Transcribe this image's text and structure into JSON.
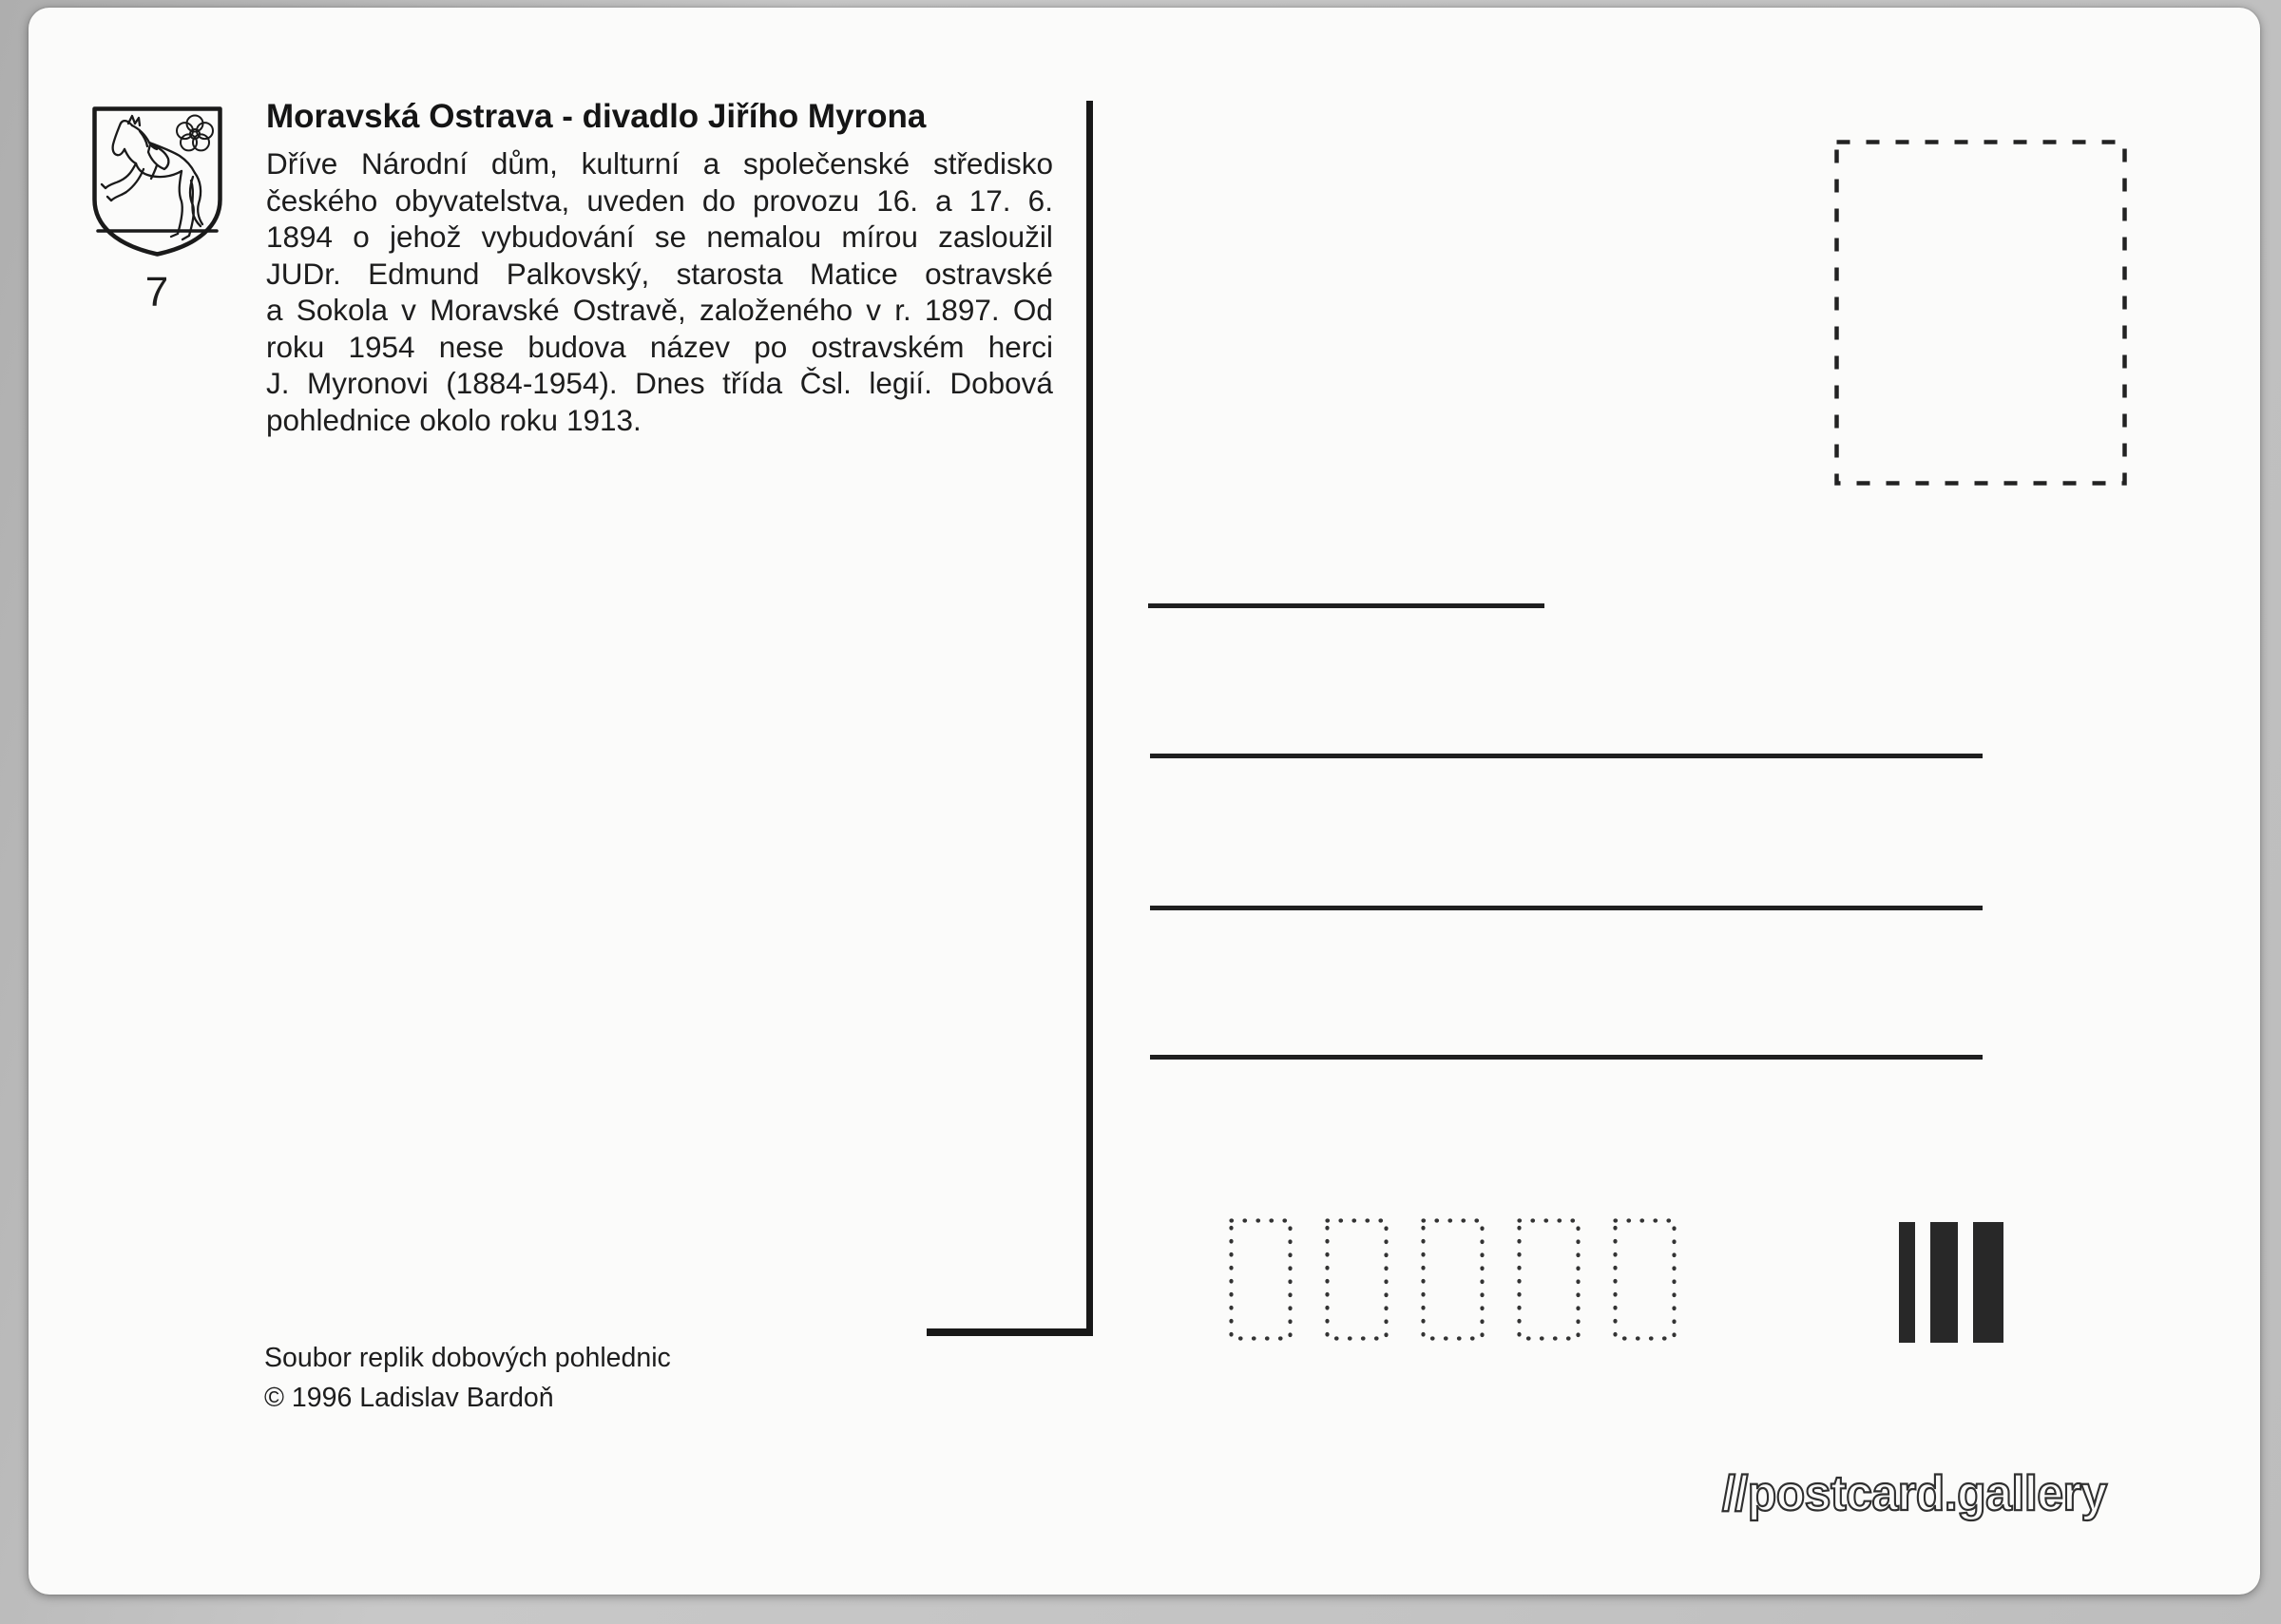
{
  "card": {
    "series_number": "7",
    "title": "Moravská Ostrava - divadlo Jiřího Myrona",
    "description_lines": [
      "Dříve Národní dům, kulturní a společenské středisko",
      "českého obyvatelstva, uveden do provozu 16. a 17. 6.",
      "1894 o jehož vybudování se nemalou mírou zasloužil",
      "JUDr. Edmund Palkovský, starosta Matice ostravské",
      "a Sokola v Moravské Ostravě, založeného v r. 1897. Od",
      "roku 1954 nese budova název po ostravském herci",
      "J. Myronovi (1884-1954). Dnes třída Čsl. legií. Dobová",
      "pohlednice okolo roku 1913."
    ],
    "publisher": {
      "line1": "Soubor replik dobových pohlednic",
      "line2": "© 1996 Ladislav Bardoň"
    },
    "watermark": "//postcard.gallery",
    "marks": {
      "crest_icon": "ostrava-coat-of-arms (leaping horse with rose)",
      "stamp_box": "dashed stamp placement square",
      "postal_code_box_count": 5,
      "sorting_bar_widths": [
        17,
        29,
        32
      ],
      "address_line_count": 3,
      "sender_line_count": 1
    }
  },
  "colors": {
    "ink": "#1d1d1d",
    "paper": "#fbfbfa",
    "scan_background": "#c3c3c3"
  }
}
